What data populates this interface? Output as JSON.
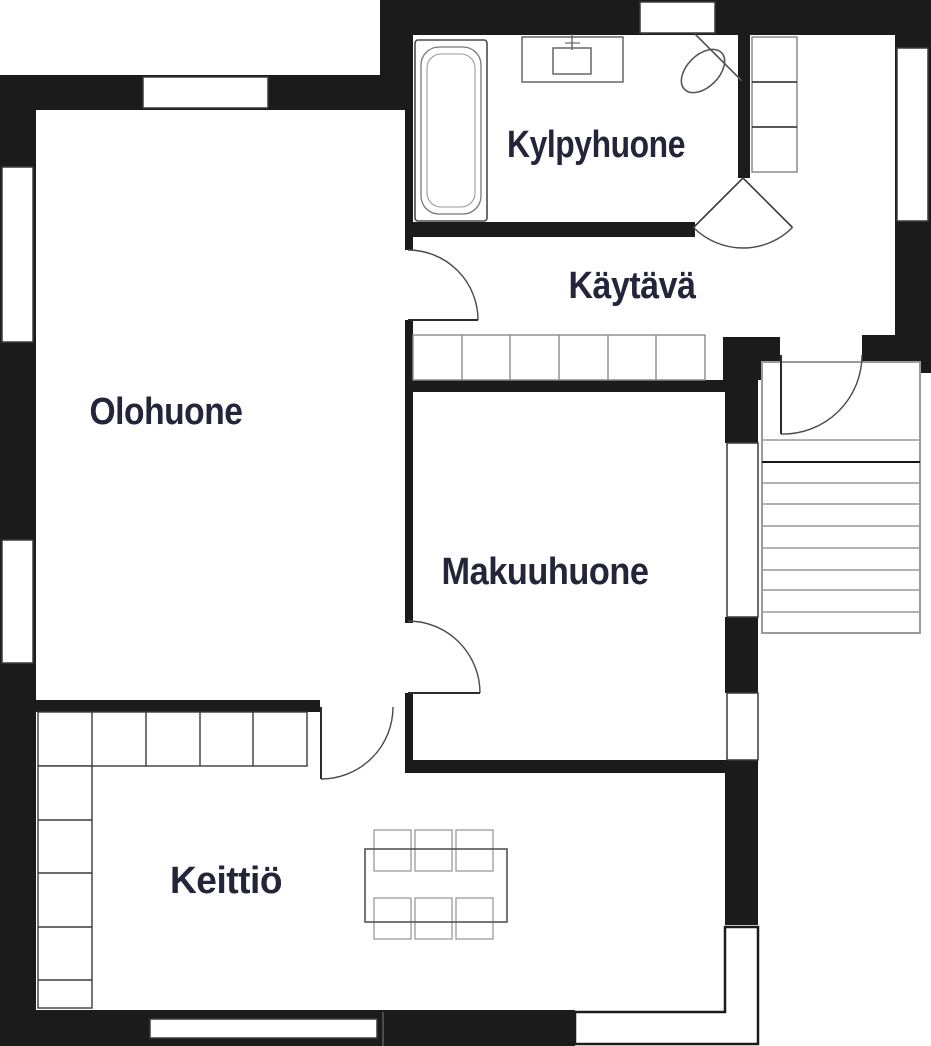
{
  "plan": {
    "kind": "apartment-floor-plan",
    "rooms": [
      {
        "id": "bathroom",
        "label": "Kylpyhuone"
      },
      {
        "id": "hallway",
        "label": "Käytävä"
      },
      {
        "id": "living-room",
        "label": "Olohuone"
      },
      {
        "id": "bedroom",
        "label": "Makuuhuone"
      },
      {
        "id": "kitchen",
        "label": "Keittiö"
      }
    ],
    "fixtures": [
      "bathtub-icon",
      "sink-icon",
      "toilet-icon",
      "cabinet-icon",
      "wardrobe-icon",
      "stairs-icon",
      "kitchen-counter-icon",
      "dining-table-icon",
      "chair-icon"
    ],
    "counts": {
      "stair_treads": 9,
      "wardrobe_sections": 6,
      "kitchen_counter_sections_top": 5,
      "kitchen_counter_sections_side": 5,
      "dining_chairs": 6,
      "windows": 8,
      "doors": 6
    },
    "colors": {
      "wall": "#1b1b1b",
      "label_text": "#23253a",
      "fixture_line": "#555555",
      "light_line": "#979797",
      "background": "#ffffff"
    }
  }
}
